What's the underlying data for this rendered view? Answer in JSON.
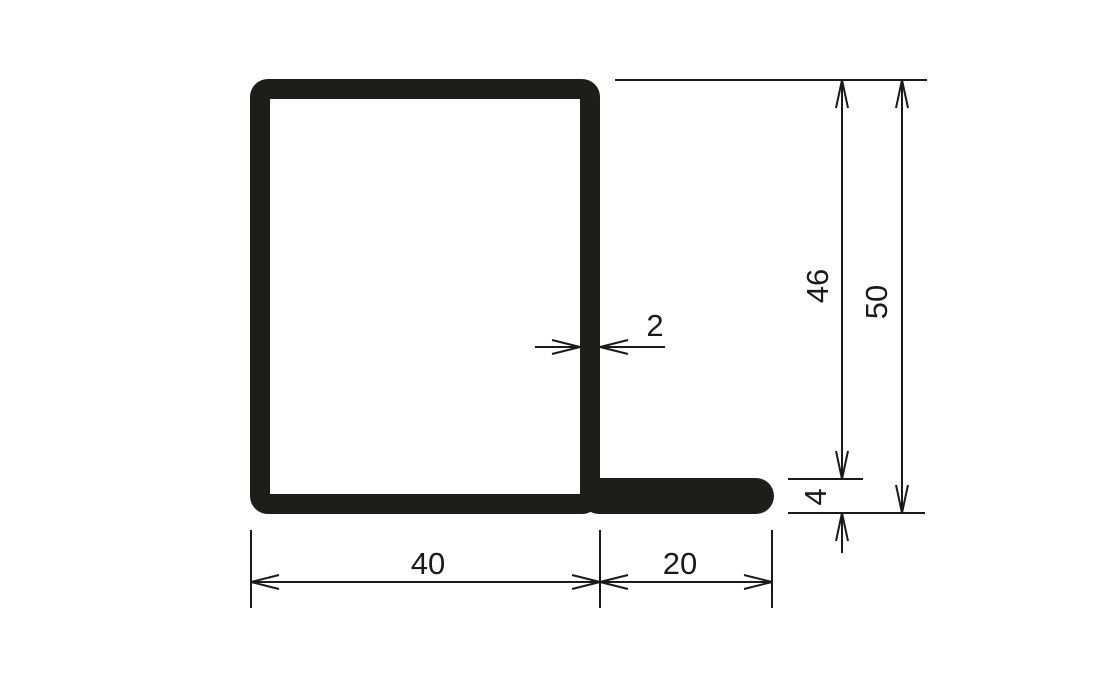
{
  "drawing": {
    "dimensions": {
      "body_width": "40",
      "flange_width": "20",
      "wall_thickness": "2",
      "flange_thickness": "4",
      "inner_height": "46",
      "overall_height": "50"
    }
  }
}
